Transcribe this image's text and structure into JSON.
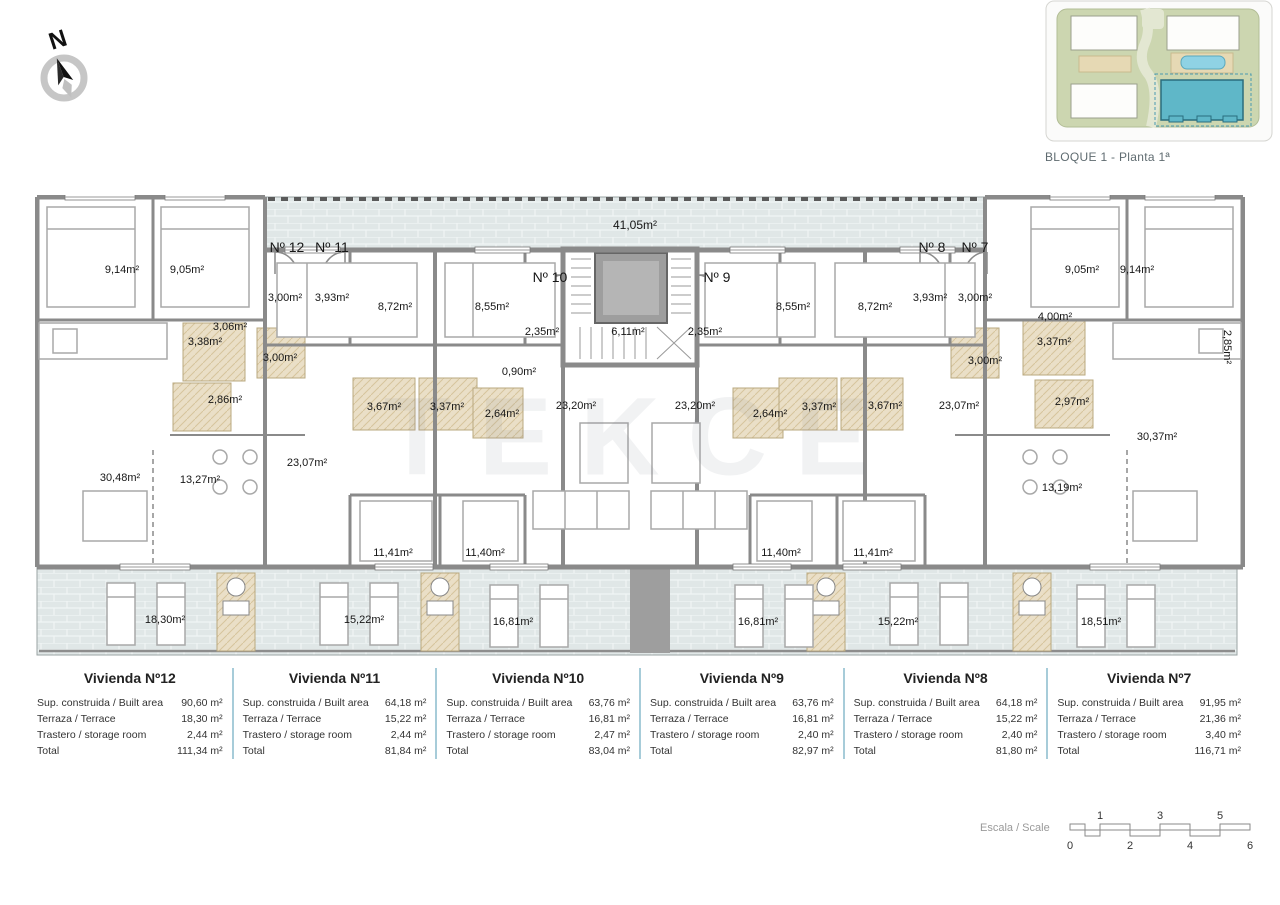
{
  "compass": {
    "label": "N"
  },
  "site_plan": {
    "caption": "BLOQUE 1 - Planta 1ª",
    "highlight_color": "#5fb7c8"
  },
  "plan": {
    "watermark": "TEKCE",
    "colors": {
      "wall": "#8a8a8a",
      "terrace": "#e0e7e7",
      "bath": "#eadfc7",
      "elevator": "#a8a8a8"
    },
    "labels": [
      {
        "t": "Nº 12",
        "x": 252,
        "y": 52,
        "k": "unit"
      },
      {
        "t": "Nº 11",
        "x": 297,
        "y": 52,
        "k": "unit"
      },
      {
        "t": "Nº 10",
        "x": 515,
        "y": 82,
        "k": "unit"
      },
      {
        "t": "Nº 9",
        "x": 682,
        "y": 82,
        "k": "unit"
      },
      {
        "t": "Nº 8",
        "x": 897,
        "y": 52,
        "k": "unit"
      },
      {
        "t": "Nº 7",
        "x": 940,
        "y": 52,
        "k": "unit"
      },
      {
        "t": "41,05m²",
        "x": 600,
        "y": 30,
        "k": "big"
      },
      {
        "t": "9,14m²",
        "x": 87,
        "y": 75
      },
      {
        "t": "9,05m²",
        "x": 152,
        "y": 75
      },
      {
        "t": "3,00m²",
        "x": 250,
        "y": 103
      },
      {
        "t": "3,93m²",
        "x": 297,
        "y": 103
      },
      {
        "t": "3,06m²",
        "x": 195,
        "y": 132
      },
      {
        "t": "3,38m²",
        "x": 170,
        "y": 147
      },
      {
        "t": "3,00m²",
        "x": 245,
        "y": 163
      },
      {
        "t": "2,86m²",
        "x": 190,
        "y": 205
      },
      {
        "t": "8,72m²",
        "x": 360,
        "y": 112
      },
      {
        "t": "8,55m²",
        "x": 457,
        "y": 112
      },
      {
        "t": "2,35m²",
        "x": 507,
        "y": 137
      },
      {
        "t": "6,11m²",
        "x": 593,
        "y": 137
      },
      {
        "t": "2,35m²",
        "x": 670,
        "y": 137
      },
      {
        "t": "8,55m²",
        "x": 758,
        "y": 112
      },
      {
        "t": "8,72m²",
        "x": 840,
        "y": 112
      },
      {
        "t": "3,93m²",
        "x": 895,
        "y": 103
      },
      {
        "t": "3,00m²",
        "x": 940,
        "y": 103
      },
      {
        "t": "4,00m²",
        "x": 1020,
        "y": 122
      },
      {
        "t": "9,05m²",
        "x": 1047,
        "y": 75
      },
      {
        "t": "9,14m²",
        "x": 1102,
        "y": 75
      },
      {
        "t": "0,90m²",
        "x": 484,
        "y": 177
      },
      {
        "t": "3,67m²",
        "x": 349,
        "y": 212
      },
      {
        "t": "3,37m²",
        "x": 412,
        "y": 212
      },
      {
        "t": "2,64m²",
        "x": 467,
        "y": 219
      },
      {
        "t": "2,64m²",
        "x": 735,
        "y": 219
      },
      {
        "t": "3,37m²",
        "x": 784,
        "y": 212
      },
      {
        "t": "3,67m²",
        "x": 850,
        "y": 211
      },
      {
        "t": "3,00m²",
        "x": 950,
        "y": 166
      },
      {
        "t": "3,37m²",
        "x": 1019,
        "y": 147
      },
      {
        "t": "2,97m²",
        "x": 1037,
        "y": 207
      },
      {
        "t": "23,20m²",
        "x": 541,
        "y": 211
      },
      {
        "t": "23,20m²",
        "x": 660,
        "y": 211
      },
      {
        "t": "23,07m²",
        "x": 272,
        "y": 268
      },
      {
        "t": "23,07m²",
        "x": 924,
        "y": 211
      },
      {
        "t": "30,48m²",
        "x": 85,
        "y": 283
      },
      {
        "t": "13,27m²",
        "x": 165,
        "y": 285
      },
      {
        "t": "11,41m²",
        "x": 358,
        "y": 358
      },
      {
        "t": "11,40m²",
        "x": 450,
        "y": 358
      },
      {
        "t": "11,40m²",
        "x": 746,
        "y": 358
      },
      {
        "t": "11,41m²",
        "x": 838,
        "y": 358
      },
      {
        "t": "13,19m²",
        "x": 1027,
        "y": 293
      },
      {
        "t": "30,37m²",
        "x": 1122,
        "y": 242
      },
      {
        "t": "2,85m²",
        "x": 1192,
        "y": 152,
        "k": "rot"
      },
      {
        "t": "18,30m²",
        "x": 130,
        "y": 425
      },
      {
        "t": "15,22m²",
        "x": 329,
        "y": 425
      },
      {
        "t": "16,81m²",
        "x": 478,
        "y": 427
      },
      {
        "t": "16,81m²",
        "x": 723,
        "y": 427
      },
      {
        "t": "15,22m²",
        "x": 863,
        "y": 427
      },
      {
        "t": "18,51m²",
        "x": 1066,
        "y": 427
      }
    ]
  },
  "tables": {
    "row_labels": [
      "Sup. construida / Built area",
      "Terraza / Terrace",
      "Trastero / storage room",
      "Total"
    ],
    "units": [
      {
        "title": "Vivienda Nº12",
        "values": [
          "90,60 m²",
          "18,30 m²",
          "2,44 m²",
          "111,34 m²"
        ]
      },
      {
        "title": "Vivienda Nº11",
        "values": [
          "64,18 m²",
          "15,22 m²",
          "2,44 m²",
          "81,84 m²"
        ]
      },
      {
        "title": "Vivienda Nº10",
        "values": [
          "63,76 m²",
          "16,81 m²",
          "2,47 m²",
          "83,04 m²"
        ]
      },
      {
        "title": "Vivienda Nº9",
        "values": [
          "63,76 m²",
          "16,81 m²",
          "2,40 m²",
          "82,97 m²"
        ]
      },
      {
        "title": "Vivienda Nº8",
        "values": [
          "64,18 m²",
          "15,22 m²",
          "2,40 m²",
          "81,80 m²"
        ]
      },
      {
        "title": "Vivienda Nº7",
        "values": [
          "91,95 m²",
          "21,36 m²",
          "3,40 m²",
          "116,71 m²"
        ]
      }
    ]
  },
  "scale": {
    "label": "Escala / Scale",
    "numbers_top": [
      "1",
      "3",
      "5"
    ],
    "numbers_bottom": [
      "0",
      "2",
      "4",
      "6"
    ]
  }
}
